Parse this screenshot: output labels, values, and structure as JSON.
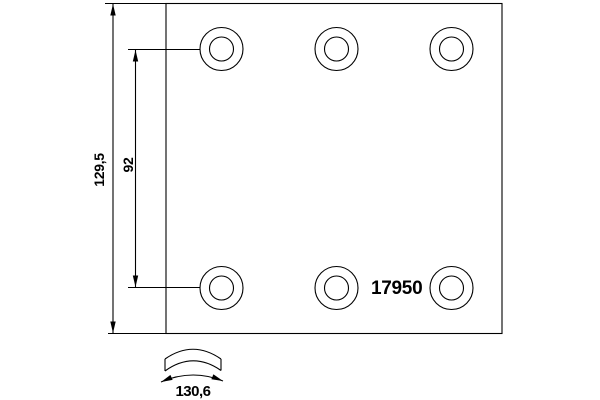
{
  "page": {
    "background": "#ffffff"
  },
  "drawing": {
    "type": "brake-lining-technical-drawing",
    "line_color": "#000000",
    "part_number": "17950",
    "dimensions": {
      "total_height": {
        "label": "129,5"
      },
      "hole_spacing": {
        "label": "92"
      },
      "arc_width": {
        "label": "130,6"
      }
    },
    "plate": {
      "hole_count": 6,
      "rows": 2,
      "columns": 3
    }
  }
}
